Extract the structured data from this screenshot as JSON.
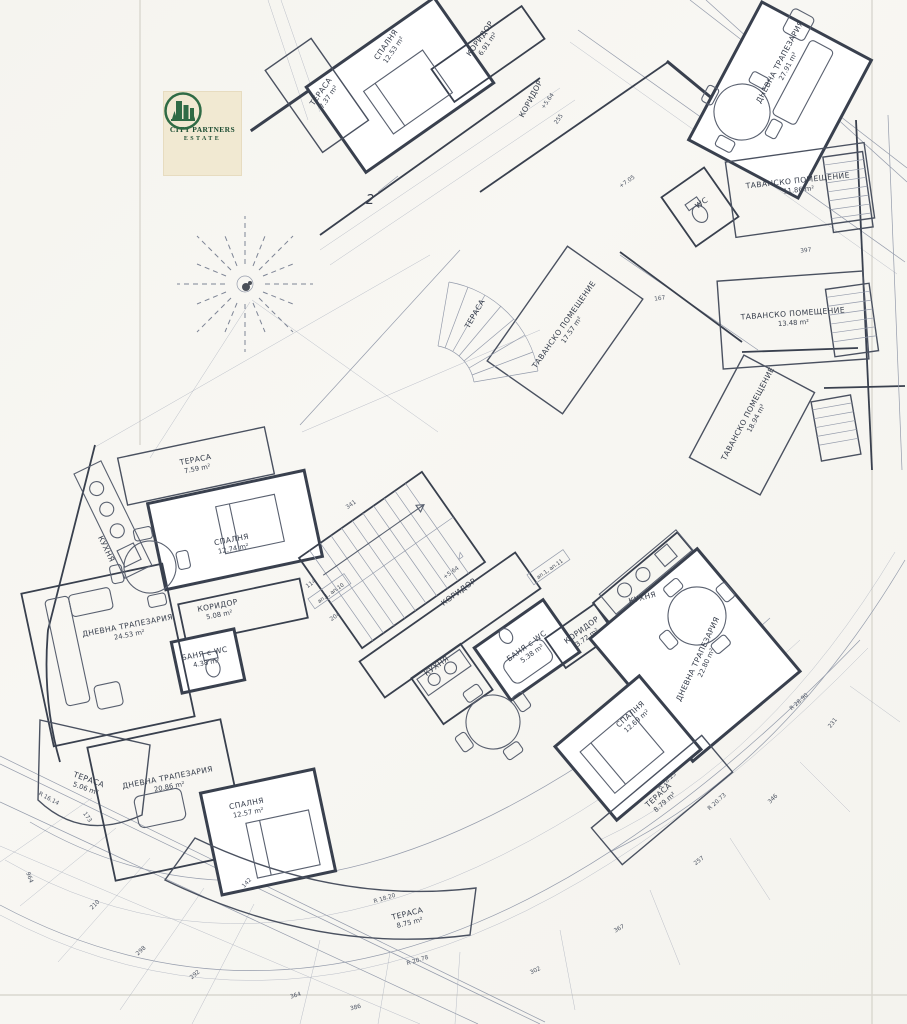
{
  "document": {
    "type": "architectural floor plan (scanned blueprint)",
    "language": "Bulgarian",
    "paper_color": "#f6f5f0",
    "ink_color": "#39404e",
    "thin_line_color": "#949bab"
  },
  "logo": {
    "line1": "CITY PARTNERS",
    "line2": "ESTATE",
    "bg_color": "#f1e9d2",
    "green": "#2f6b45",
    "emblem": "buildings-and-trees-in-circle"
  },
  "section_mark": "2",
  "rooms": [
    {
      "name": "СПАЛНЯ",
      "area": "12.53 m²"
    },
    {
      "name": "ТЕРАСА",
      "area": "7.37 m²"
    },
    {
      "name": "КОРИДОР",
      "area": "6.91 m²"
    },
    {
      "name": "ДНЕВНА ТРАПЕЗАРИЯ",
      "area": "27.91 m²"
    },
    {
      "name": "ТАВАНСКО ПОМЕЩЕНИЕ",
      "area": "11.86 m²"
    },
    {
      "name": "ТАВАНСКО ПОМЕЩЕНИЕ",
      "area": "13.48 m²"
    },
    {
      "name": "ТАВАНСКО ПОМЕЩЕНИЕ",
      "area": "18.94 m²"
    },
    {
      "name": "ТАВАНСКО ПОМЕЩЕНИЕ",
      "area": "17.57 m²"
    },
    {
      "name": "WC",
      "area": ""
    },
    {
      "name": "КОРИДОР",
      "area": ""
    },
    {
      "name": "ТЕРАСА",
      "area": "7.59 m²"
    },
    {
      "name": "СПАЛНЯ",
      "area": "12.74 m²"
    },
    {
      "name": "КУХНЯ",
      "area": ""
    },
    {
      "name": "КОРИДОР",
      "area": "5.08 m²"
    },
    {
      "name": "БАНЯ с WC",
      "area": "4.38 m²"
    },
    {
      "name": "ДНЕВНА ТРАПЕЗАРИЯ",
      "area": "24.53 m²"
    },
    {
      "name": "ТЕРАСА",
      "area": "5.06 m²"
    },
    {
      "name": "ДНЕВНА ТРАПЕЗАРИЯ",
      "area": "20.86 m²"
    },
    {
      "name": "СПАЛНЯ",
      "area": "12.57 m²"
    },
    {
      "name": "ТЕРАСА",
      "area": "8.75 m²"
    },
    {
      "name": "КОРИДОР",
      "area": ""
    },
    {
      "name": "КУХНЯ",
      "area": ""
    },
    {
      "name": "БАНЯ с WC",
      "area": "5.38 m²"
    },
    {
      "name": "КОРИДОР",
      "area": "3.72 m²"
    },
    {
      "name": "КУХНЯ",
      "area": ""
    },
    {
      "name": "ДНЕВНА ТРАПЕЗАРИЯ",
      "area": "22.80 m²"
    },
    {
      "name": "СПАЛНЯ",
      "area": "12.69 m²"
    },
    {
      "name": "ТЕРАСА",
      "area": "8.79 m²"
    },
    {
      "name": "ТЕРАСА",
      "area": ""
    }
  ],
  "annotations": {
    "elevations": [
      "+5.64",
      "+5.64",
      "+7.05"
    ],
    "radii": [
      "R 16.14",
      "R 18.20",
      "R 20.78",
      "R 18.23",
      "R 20.73",
      "R 28.90"
    ],
    "apartments": [
      "ап.1, ап.10",
      "ап.1, ап.11"
    ]
  },
  "dims": [
    "964",
    "364",
    "386",
    "298",
    "292",
    "210",
    "142",
    "173",
    "302",
    "367",
    "257",
    "346",
    "231",
    "204",
    "114",
    "341",
    "255",
    "167",
    "397"
  ]
}
